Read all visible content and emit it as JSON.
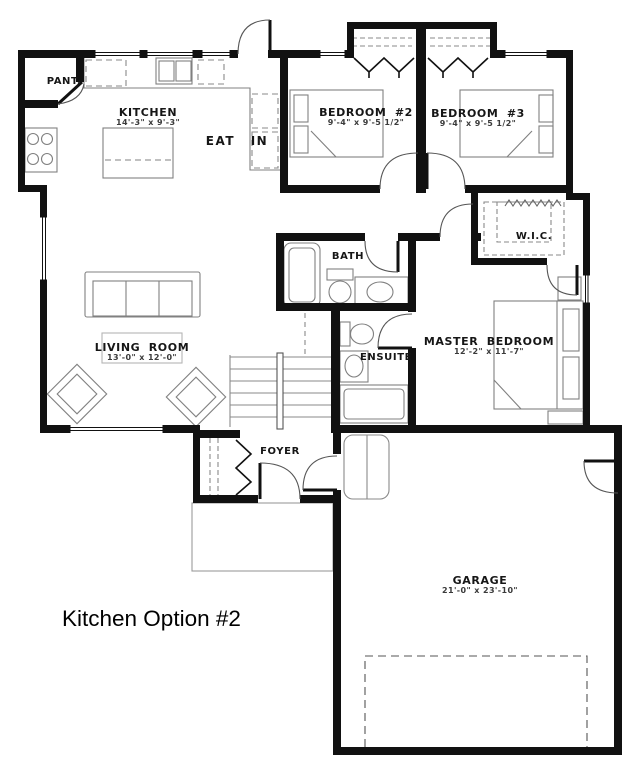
{
  "title": "Kitchen Option #2",
  "colors": {
    "wall": "#111111",
    "fixture_line": "#808080",
    "background": "#ffffff"
  },
  "rooms": {
    "pantry": {
      "label": "PANT."
    },
    "kitchen": {
      "label": "KITCHEN",
      "dims": "14'-3\" x 9'-3\""
    },
    "eat_in": {
      "label": "EAT IN"
    },
    "bedroom_2": {
      "label": "BEDROOM #2",
      "dims": "9'-4\" x 9'-5 1/2\""
    },
    "bedroom_3": {
      "label": "BEDROOM #3",
      "dims": "9'-4\" x 9'-5 1/2\""
    },
    "wic": {
      "label": "W.I.C."
    },
    "bath": {
      "label": "BATH"
    },
    "master_bedroom": {
      "label": "MASTER BEDROOM",
      "dims": "12'-2\" x 11'-7\""
    },
    "living_room": {
      "label": "LIVING ROOM",
      "dims": "13'-0\" x 12'-0\""
    },
    "ensuite": {
      "label": "ENSUITE"
    },
    "foyer": {
      "label": "FOYER"
    },
    "garage": {
      "label": "GARAGE",
      "dims": "21'-0\" x 23'-10\""
    }
  }
}
